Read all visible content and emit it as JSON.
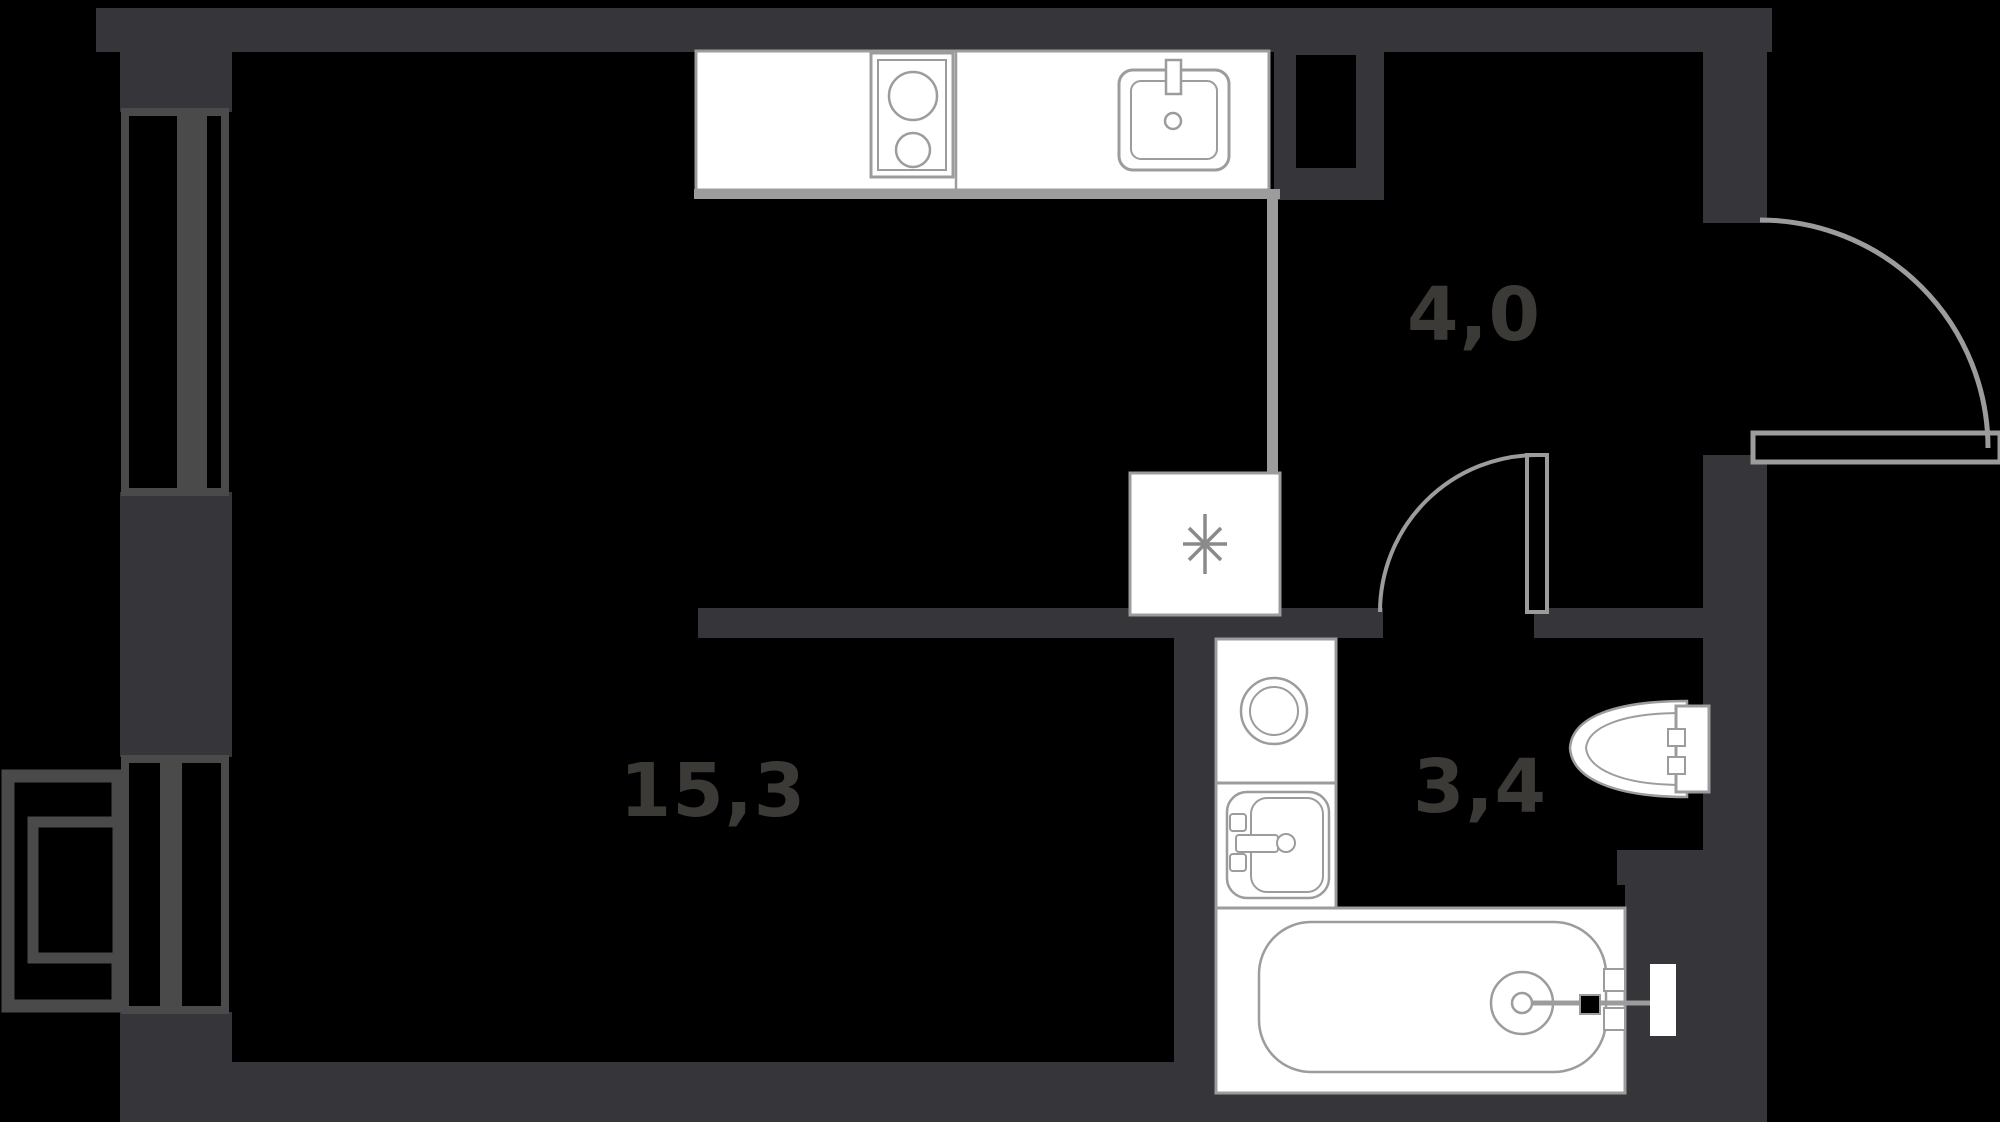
{
  "plan": {
    "kind": "studio-apartment-floor-plan",
    "rooms": [
      {
        "id": "living-kitchen",
        "area_label": "15,3"
      },
      {
        "id": "hallway",
        "area_label": "4,0"
      },
      {
        "id": "bathroom",
        "area_label": "3,4"
      }
    ],
    "symbols": {
      "fridge_marker": "✳"
    },
    "fixtures": [
      "kitchen-counter",
      "cooktop",
      "kitchen-sink",
      "refrigerator-marker",
      "ventilation-shaft",
      "entrance-door",
      "bathroom-door",
      "washing-machine",
      "bathroom-sink",
      "bathtub",
      "toilet",
      "window",
      "balcony-door",
      "balcony"
    ],
    "colors": {
      "background": "#000000",
      "wall": "#35353a",
      "window_frame": "#4a4a4a",
      "fixture_fill": "#ffffff",
      "fixture_outline": "#9c9c9c",
      "label_text": "#3b3a37",
      "marker": "#8a8a8a"
    }
  }
}
